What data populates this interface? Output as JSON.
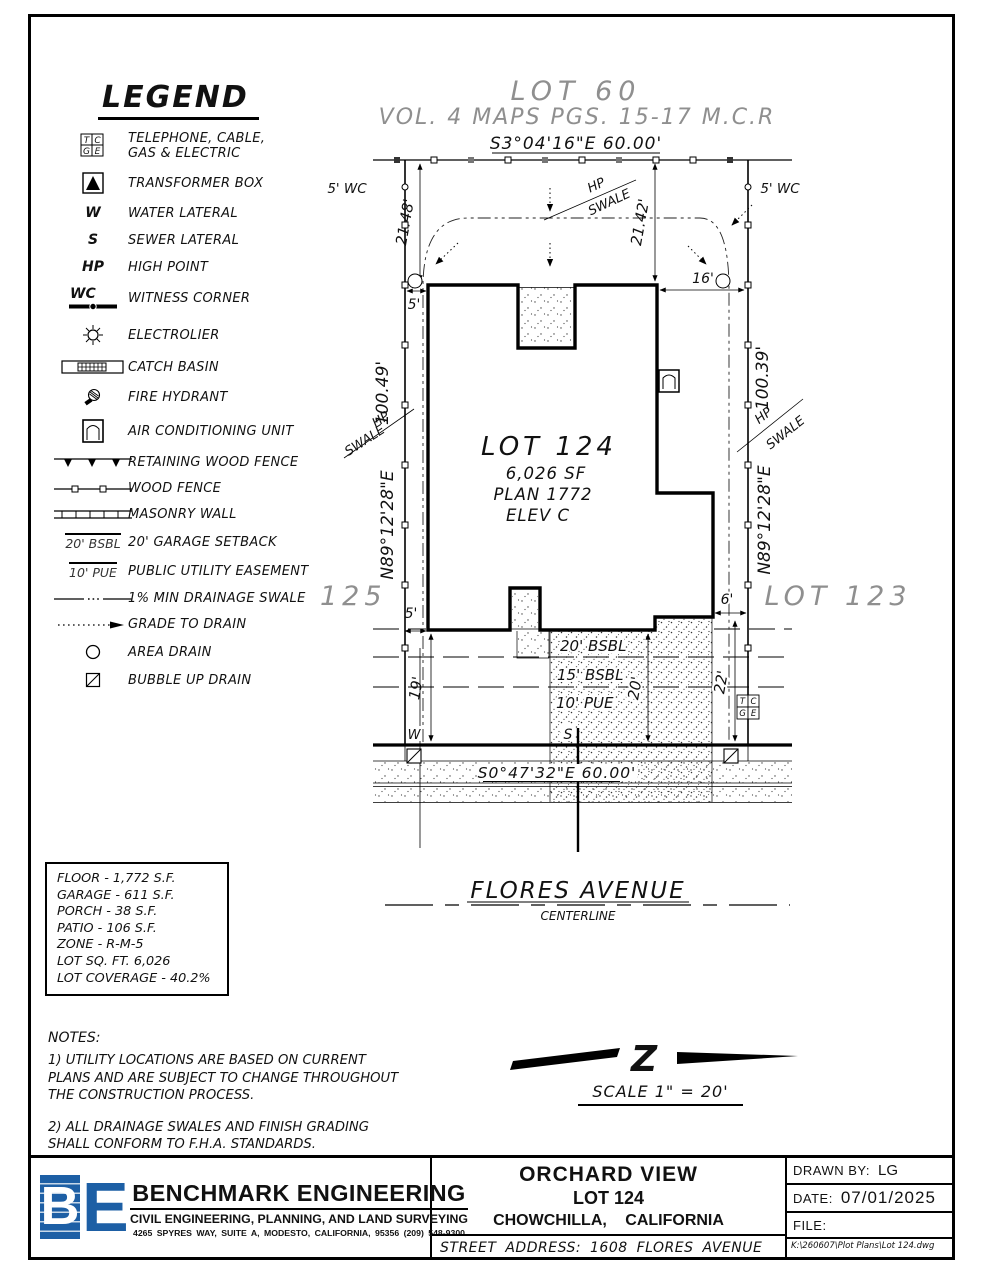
{
  "colors": {
    "ink": "#000000",
    "gray": "#8f8f8f",
    "blue": "#1d5fa5"
  },
  "legend": {
    "title": "LEGEND",
    "items": [
      {
        "label": "TELEPHONE, CABLE,",
        "label2": "GAS & ELECTRIC",
        "t": "T",
        "c": "C",
        "g": "G",
        "e": "E"
      },
      {
        "label": "TRANSFORMER BOX"
      },
      {
        "sym": "W",
        "label": "WATER LATERAL"
      },
      {
        "sym": "S",
        "label": "SEWER LATERAL"
      },
      {
        "sym": "HP",
        "label": "HIGH POINT"
      },
      {
        "sym": "WC",
        "label": "WITNESS CORNER"
      },
      {
        "label": "ELECTROLIER"
      },
      {
        "label": "CATCH BASIN"
      },
      {
        "label": "FIRE HYDRANT"
      },
      {
        "label": "AIR CONDITIONING UNIT"
      },
      {
        "label": "RETAINING WOOD FENCE"
      },
      {
        "label": "WOOD FENCE"
      },
      {
        "label": "MASONRY WALL"
      },
      {
        "sym": "20' BSBL",
        "label": "20' GARAGE SETBACK"
      },
      {
        "sym": "10' PUE",
        "label": "PUBLIC UTILITY EASEMENT"
      },
      {
        "label": "1% MIN DRAINAGE SWALE"
      },
      {
        "label": "GRADE TO DRAIN"
      },
      {
        "label": "AREA DRAIN"
      },
      {
        "label": "BUBBLE UP DRAIN"
      }
    ]
  },
  "plan": {
    "lot60": "LOT 60",
    "vol": "VOL. 4 MAPS PGS. 15-17 M.C.R",
    "rear_bearing": "S3°04'16\"E 60.00'",
    "front_bearing": "S0°47'32\"E 60.00'",
    "wc_left": "5' WC",
    "wc_right": "5' WC",
    "dim_2148": "21.48'",
    "dim_2142": "21.42'",
    "dim_16": "16'",
    "dim_5_top": "5'",
    "dim_5_bot": "5'",
    "dim_6": "6'",
    "dim_19": "19'",
    "dim_20": "20'",
    "dim_22": "22'",
    "left_dist": "100.49'",
    "right_dist": "100.39'",
    "left_bearing": "N89°12'28\"E",
    "right_bearing": "N89°12'28\"E",
    "hp": "HP",
    "swale": "SWALE",
    "lot125": "LOT 125",
    "lot123": "LOT 123",
    "lot_name": "LOT 124",
    "lot_sf": "6,026 SF",
    "lot_plan": "PLAN 1772",
    "lot_elev": "ELEV C",
    "bsbl20": "20' BSBL",
    "bsbl15": "15' BSBL",
    "pue10": "10' PUE",
    "w": "W",
    "s": "S",
    "tcge": {
      "t": "T",
      "c": "C",
      "g": "G",
      "e": "E"
    }
  },
  "street": {
    "name": "FLORES AVENUE",
    "sub": "CENTERLINE"
  },
  "stats": {
    "lines": [
      "FLOOR - 1,772 S.F.",
      "GARAGE - 611 S.F.",
      "PORCH - 38 S.F.",
      "PATIO - 106 S.F.",
      "ZONE - R-M-5",
      "LOT SQ. FT. 6,026",
      "LOT COVERAGE - 40.2%"
    ]
  },
  "notes": {
    "title": "NOTES:",
    "n1": "1) UTILITY LOCATIONS ARE BASED ON CURRENT PLANS AND ARE SUBJECT TO CHANGE THROUGHOUT THE CONSTRUCTION PROCESS.",
    "n2": "2) ALL DRAINAGE SWALES AND FINISH GRADING SHALL CONFORM TO F.H.A. STANDARDS."
  },
  "scale": {
    "label": "SCALE 1\" = 20'"
  },
  "titleblock": {
    "logo_b": "B",
    "logo_e": "E",
    "company": "BENCHMARK ENGINEERING",
    "tagline": "CIVIL ENGINEERING, PLANNING, AND LAND SURVEYING",
    "address": "4265 SPYRES WAY, SUITE A, MODESTO, CALIFORNIA, 95356   (209) 548-9300",
    "project": "ORCHARD VIEW",
    "lot": "LOT 124",
    "city": "CHOWCHILLA, CALIFORNIA",
    "street_address": "STREET ADDRESS: 1608 FLORES AVENUE",
    "drawn_label": "DRAWN BY:",
    "drawn": "LG",
    "date_label": "DATE:",
    "date": "07/01/2025",
    "file_label": "FILE:",
    "file_path": "K:\\260607\\Plot Plans\\Lot 124.dwg"
  }
}
